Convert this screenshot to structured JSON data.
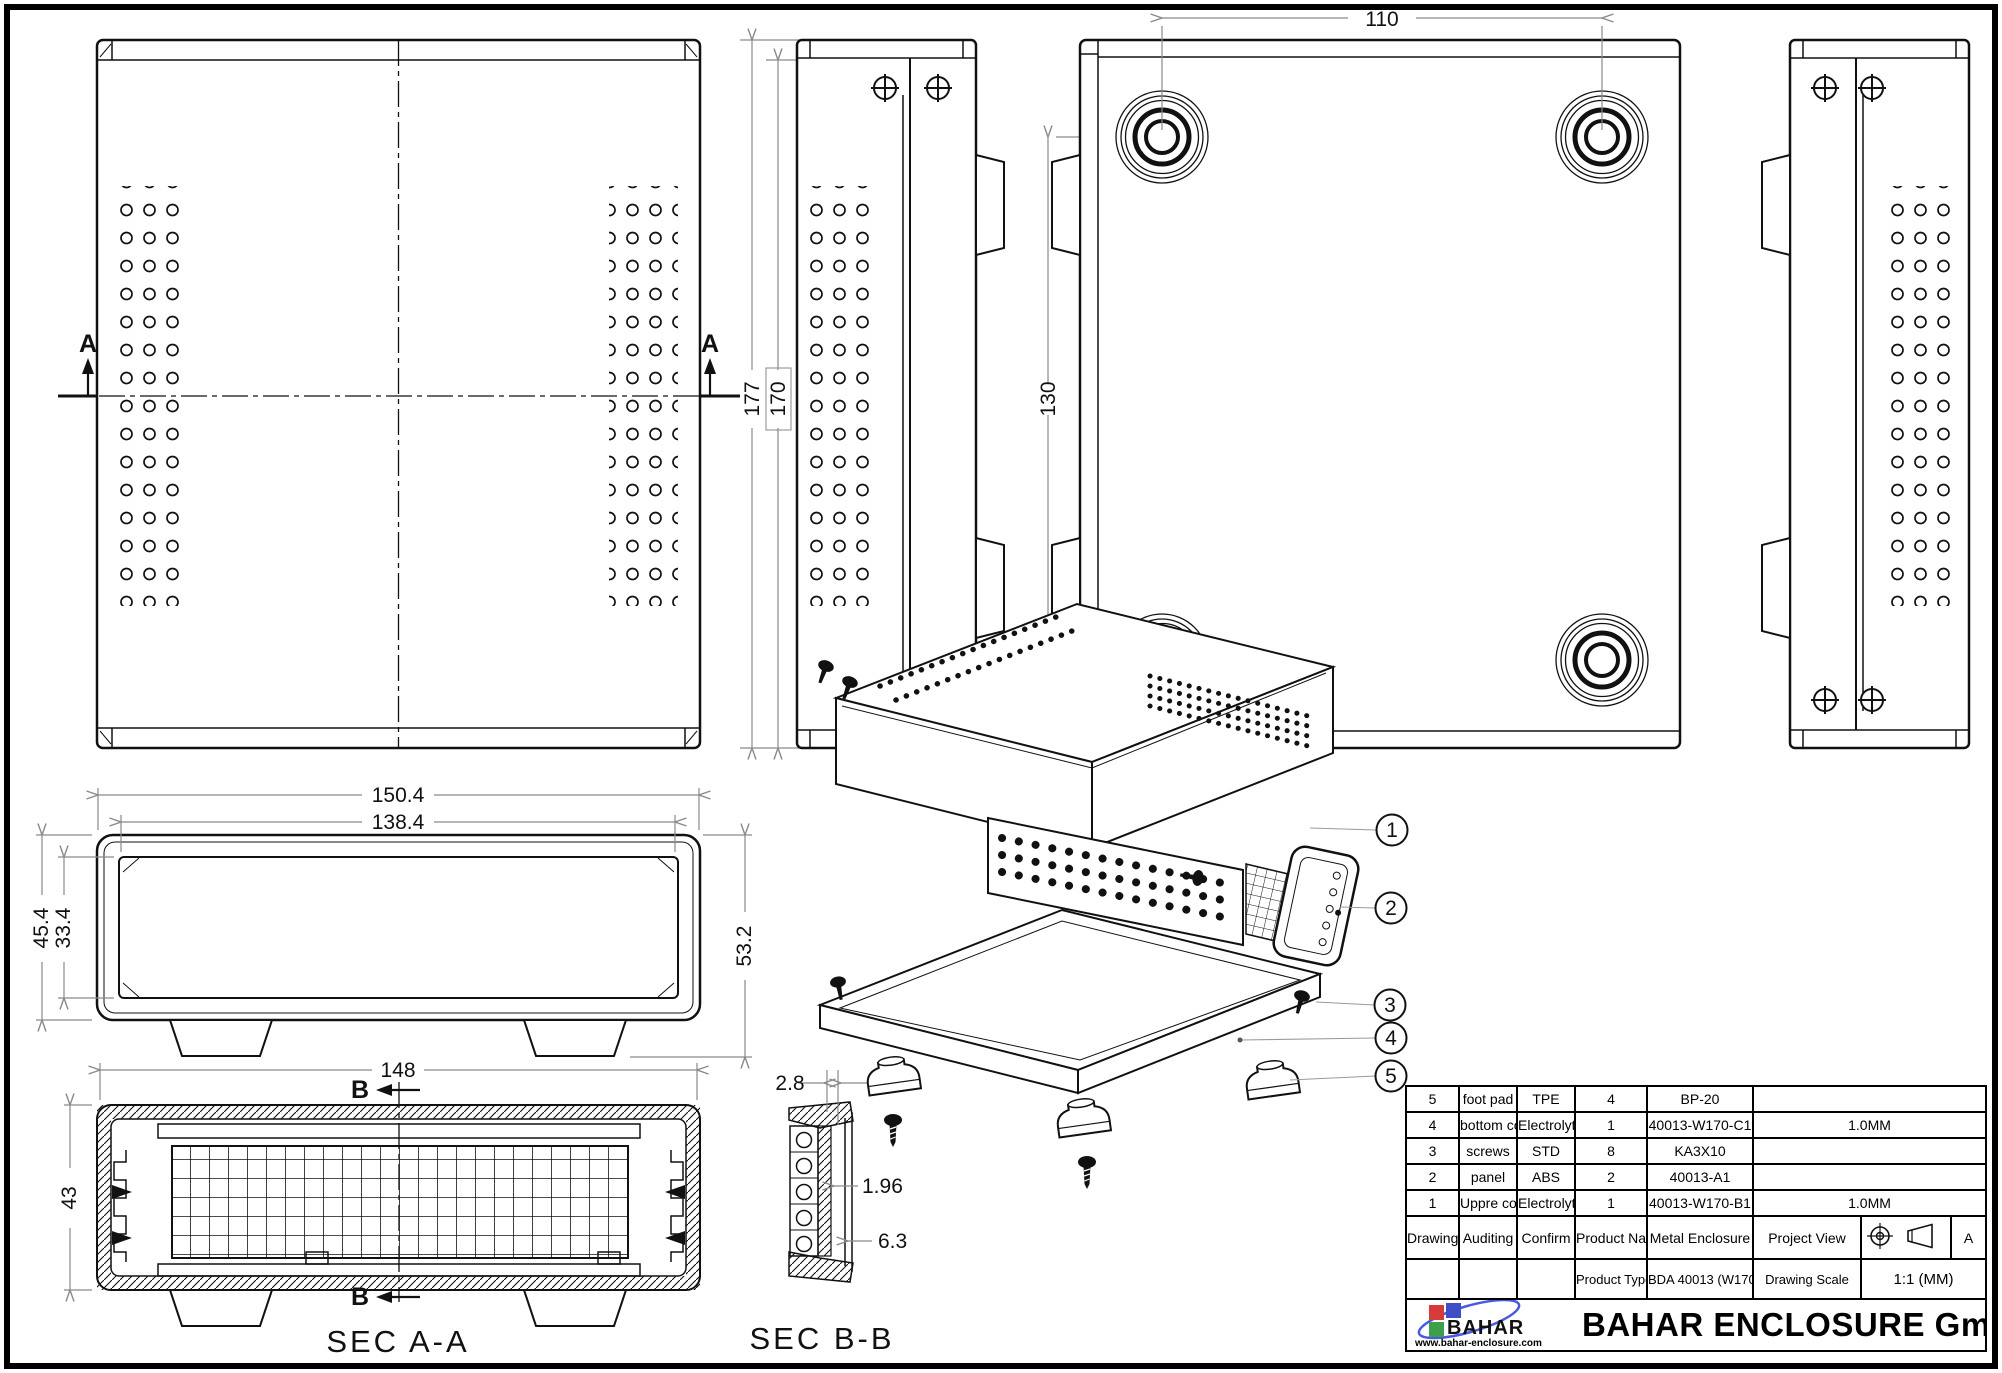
{
  "drawing": {
    "markers": {
      "section_a": "A",
      "section_b": "B"
    },
    "section_titles": {
      "aa": "SEC A-A",
      "bb": "SEC B-B"
    },
    "dims": {
      "bottom_width": "110",
      "bottom_height": "130",
      "side_total_h": "177",
      "side_body_h": "170",
      "front_total_w": "150.4",
      "front_bezel_w": "138.4",
      "front_body_h": "45.4",
      "front_bezel_h": "33.4",
      "front_overall_h": "53.2",
      "secaa_width": "148",
      "secaa_height": "43",
      "secbb_gap": "2.8",
      "secbb_thickness": "1.96",
      "secbb_depth": "6.3"
    },
    "callouts": [
      "1",
      "2",
      "3",
      "4",
      "5"
    ]
  },
  "bom": {
    "rows": [
      {
        "no": "5",
        "name": "foot pad",
        "material": "TPE",
        "qty": "4",
        "spec": "BP-20",
        "note": ""
      },
      {
        "no": "4",
        "name": "bottom cover",
        "material": "Electrolytic sheet",
        "qty": "1",
        "spec": "40013-W170-C1",
        "note": "1.0MM"
      },
      {
        "no": "3",
        "name": "screws",
        "material": "STD",
        "qty": "8",
        "spec": "KA3X10",
        "note": ""
      },
      {
        "no": "2",
        "name": "panel",
        "material": "ABS",
        "qty": "2",
        "spec": "40013-A1",
        "note": ""
      },
      {
        "no": "1",
        "name": "Uppre cover",
        "material": "Electrolytic sheet",
        "qty": "1",
        "spec": "40013-W170-B1",
        "note": "1.0MM"
      }
    ]
  },
  "title_block": {
    "drawing_label": "Drawing",
    "auditing_label": "Auditing",
    "confirm_label": "Confirm",
    "product_name_label": "Product Name",
    "product_name": "Metal Enclosure",
    "project_view_label": "Project View",
    "view_code": "A",
    "product_type_label": "Product Type",
    "product_type": "BDA 40013 (W170)",
    "drawing_scale_label": "Drawing Scale",
    "drawing_scale": "1:1 (MM)"
  },
  "footer": {
    "logo_text": "BAHAR",
    "website": "www.bahar-enclosure.com",
    "company": "BAHAR ENCLOSURE GmbH"
  },
  "colors": {
    "line": "#111111",
    "dim_line": "#8a8a8a",
    "logo_red": "#d63a3a",
    "logo_blue": "#3f4ec4",
    "logo_green": "#3d9e4b",
    "logo_swoosh": "#4a5ae0"
  }
}
